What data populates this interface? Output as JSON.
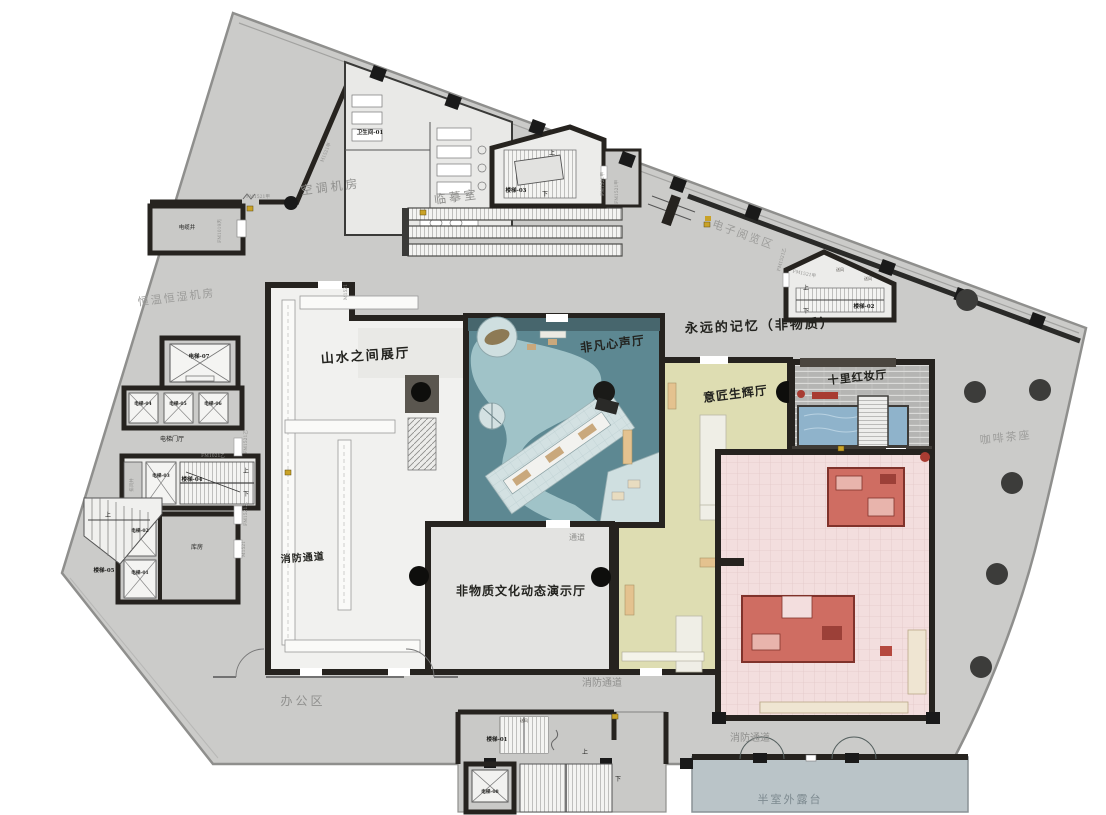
{
  "drawing": {
    "type": "architectural-floor-plan",
    "language": "zh-CN",
    "colors": {
      "shell": "#cbcbc9",
      "wall": "#26231f",
      "hall_white": "#f1f1ef",
      "teal_hall": "#5d8892",
      "teal_river": "#a3c6cb",
      "teal_tile": "#d3e1e2",
      "yellow_hall": "#deddb2",
      "pink_hall": "#f3dede",
      "red_furniture": "#cf6d62",
      "brick": "#b5b5b3",
      "pool": "#8fb3cb",
      "terrace": "#bac4c8",
      "gold_marker": "#c9a227"
    }
  },
  "labels": {
    "kongtiao": "空调机房",
    "linmo": "临摹室",
    "wsj": "卫生间-01",
    "dianzi": "电子阅览区",
    "yongyuan": "永远的记忆（非物质）",
    "hengwen": "恒温恒湿机房",
    "shanshui": "山水之间展厅",
    "feifan": "非凡心声厅",
    "yijiang": "意匠生辉厅",
    "hongzhuang": "十里红妆厅",
    "kafei": "咖啡茶座",
    "dongtai": "非物质文化动态演示厅",
    "tongdao": "通道",
    "xiaofang": "消防通道",
    "bangong": "办公区",
    "banshi": "半室外露台",
    "kufang": "库房",
    "diantiting": "电梯门厅",
    "dianlanjing": "电缆井",
    "paifengjing": "排风井",
    "lt01": "楼梯-01",
    "lt02": "楼梯-02",
    "lt03": "楼梯-03",
    "lt04": "楼梯-04",
    "lt05": "楼梯-05",
    "dt01": "电梯-01",
    "dt02": "电梯-02",
    "dt03": "电梯-03",
    "dt04": "电梯-04",
    "dt05": "电梯-05",
    "dt06": "电梯-06",
    "dt07": "电梯-07",
    "dt08": "电梯-08",
    "shang": "上",
    "xia": "下",
    "songfeng": "送风",
    "fm1521a": "FM1521甲",
    "fm1521b": "FM1521乙",
    "fm1021b": "FM1021乙",
    "fm1019c": "FM1019丙",
    "m1521": "M1521",
    "m1521a": "M1521甲"
  }
}
